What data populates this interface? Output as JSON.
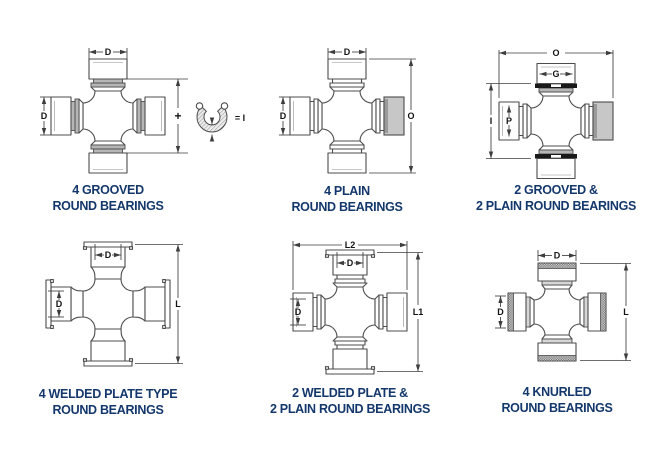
{
  "sheet": {
    "background": "#ffffff",
    "caption_color": "#14386c",
    "line_color": "#4c4c4c",
    "shade_color": "#b6b6b6",
    "gray_cap_color": "#c7c7c7",
    "groove_color": "#191919"
  },
  "diagrams": [
    {
      "name": "4-grooved-round-bearings",
      "caption": [
        "4 GROOVED",
        "ROUND BEARINGS"
      ],
      "dims": {
        "top": "D",
        "left": "D",
        "height_plus": "+",
        "snap_ring_equals": "= I"
      }
    },
    {
      "name": "4-plain-round-bearings",
      "caption": [
        "4 PLAIN",
        "ROUND BEARINGS"
      ],
      "dims": {
        "top": "D",
        "left": "D",
        "overall": "O"
      }
    },
    {
      "name": "2-grooved-2-plain-round-bearings",
      "caption": [
        "2 GROOVED &",
        "2 PLAIN ROUND BEARINGS"
      ],
      "dims": {
        "overall": "O",
        "cap": "G",
        "inside": "I",
        "bore": "P"
      }
    },
    {
      "name": "4-welded-plate-type-round-bearings",
      "caption": [
        "4 WELDED PLATE TYPE",
        "ROUND BEARINGS"
      ],
      "dims": {
        "top": "D",
        "left": "D",
        "length": "L"
      }
    },
    {
      "name": "2-welded-plate-2-plain-round-bearings",
      "caption": [
        "2 WELDED PLATE &",
        "2 PLAIN ROUND BEARINGS"
      ],
      "dims": {
        "width": "L2",
        "top": "D",
        "left": "D",
        "length": "L1"
      }
    },
    {
      "name": "4-knurled-round-bearings",
      "caption": [
        "4 KNURLED",
        "ROUND BEARINGS"
      ],
      "dims": {
        "top": "D",
        "left": "D",
        "length": "L"
      }
    }
  ]
}
